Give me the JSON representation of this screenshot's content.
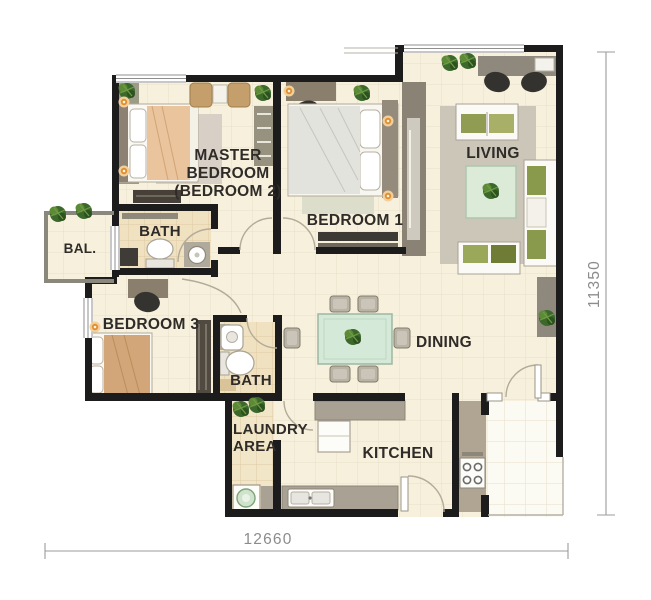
{
  "rooms": {
    "master_bedroom": {
      "lines": [
        "MASTER",
        "BEDROOM",
        "(BEDROOM 2)"
      ]
    },
    "bedroom_1": {
      "label": "BEDROOM 1"
    },
    "bedroom_3": {
      "label": "BEDROOM 3"
    },
    "living": {
      "label": "LIVING"
    },
    "dining": {
      "label": "DINING"
    },
    "kitchen": {
      "label": "KITCHEN"
    },
    "bath_master": {
      "label": "BATH"
    },
    "bath_2": {
      "label": "BATH"
    },
    "balcony": {
      "label": "BAL."
    },
    "laundry": {
      "lines": [
        "LAUNDRY",
        "AREA"
      ]
    }
  },
  "dimensions": {
    "width_mm": "12660",
    "height_mm": "11350"
  },
  "colors": {
    "wall": "#1c1c1c",
    "floor": "#f6f0dc",
    "bath_floor": "#f0e1c0",
    "counter_gray": "#a9a294",
    "plant_green": "#3c682c",
    "glass_green": "#d5e9d8",
    "dim_gray": "#8c8c8c"
  }
}
